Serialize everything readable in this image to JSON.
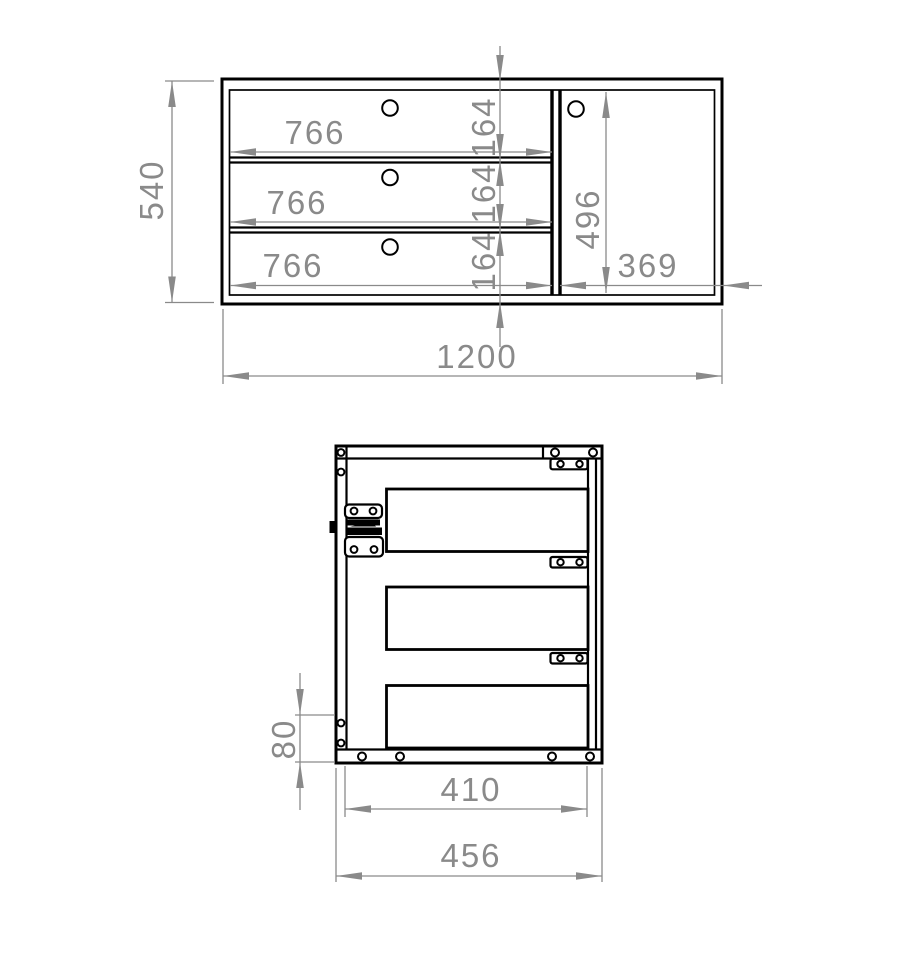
{
  "front_view": {
    "overall_width": "1200",
    "overall_height": "540",
    "drawer_widths": [
      "766",
      "766",
      "766"
    ],
    "drawer_heights": [
      "164",
      "164",
      "164"
    ],
    "door_height": "496",
    "door_width": "369"
  },
  "side_view": {
    "overall_depth": "456",
    "interior_depth": "410",
    "bottom_offset": "80"
  },
  "style": {
    "outline_color": "#000000",
    "dimension_color": "#8a8a8a",
    "background_color": "#ffffff"
  }
}
